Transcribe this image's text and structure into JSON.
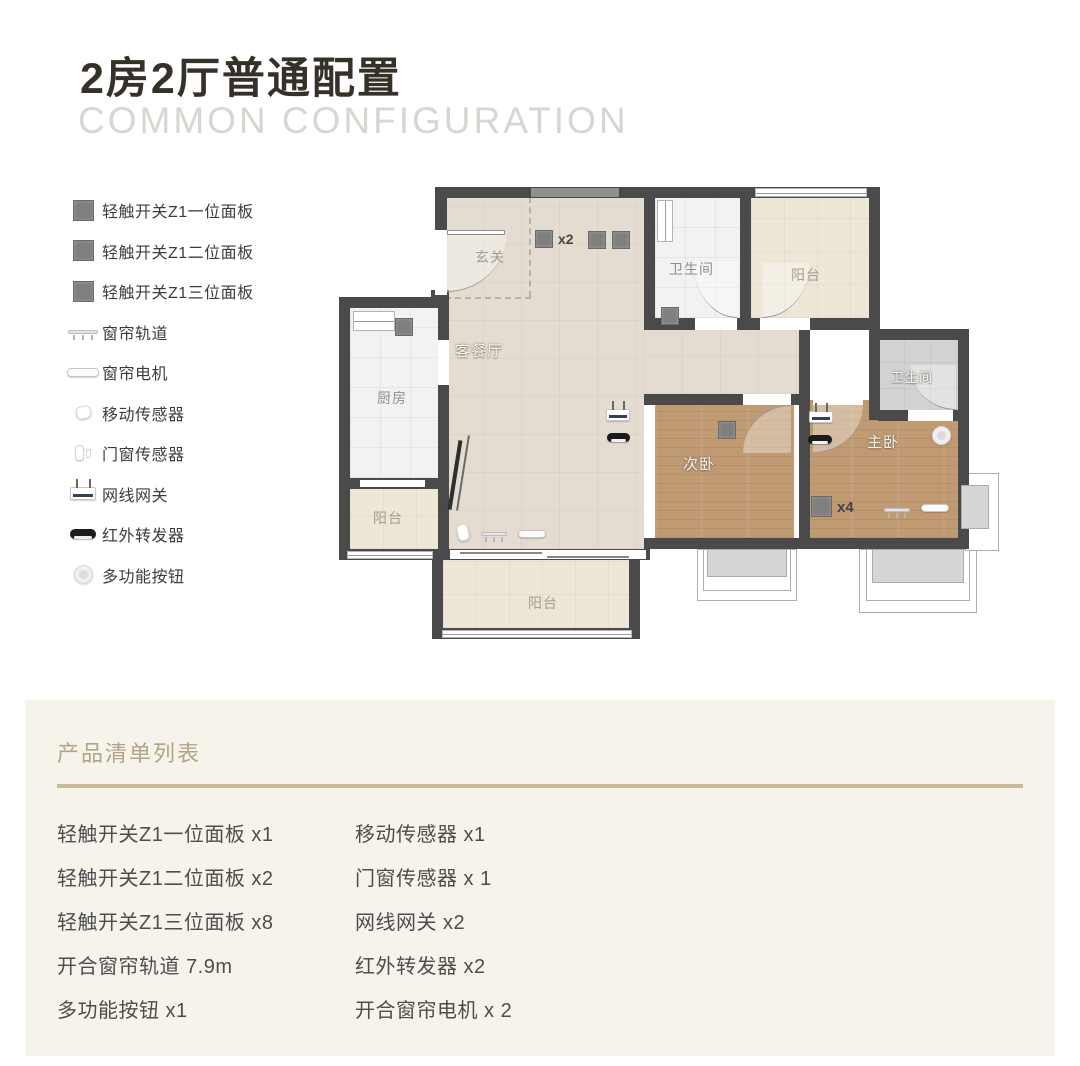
{
  "header": {
    "title": "2房2厅普通配置",
    "subtitle": "COMMON CONFIGURATION"
  },
  "legend": {
    "items": [
      {
        "icon": "switch-panel-icon",
        "label": "轻触开关Z1一位面板"
      },
      {
        "icon": "switch-panel-icon",
        "label": "轻触开关Z1二位面板"
      },
      {
        "icon": "switch-panel-icon",
        "label": "轻触开关Z1三位面板"
      },
      {
        "icon": "curtain-track-icon",
        "label": "窗帘轨道"
      },
      {
        "icon": "curtain-motor-icon",
        "label": "窗帘电机"
      },
      {
        "icon": "motion-sensor-icon",
        "label": "移动传感器"
      },
      {
        "icon": "door-sensor-icon",
        "label": "门窗传感器"
      },
      {
        "icon": "gateway-icon",
        "label": "网线网关"
      },
      {
        "icon": "ir-repeater-icon",
        "label": "红外转发器"
      },
      {
        "icon": "multi-button-icon",
        "label": "多功能按钮"
      }
    ]
  },
  "floorplan": {
    "rooms": {
      "entry": "玄关",
      "living": "客餐厅",
      "kitchen": "厨房",
      "bath1": "卫生间",
      "balcony_tr": "阳台",
      "bath2": "卫生间",
      "bedroom2": "次卧",
      "master": "主卧",
      "balcony_left": "阳台",
      "balcony_bottom": "阳台"
    },
    "multipliers": {
      "living_panels": "x2",
      "master_panels": "x4"
    }
  },
  "product_list": {
    "heading": "产品清单列表",
    "col1": [
      "轻触开关Z1一位面板 x1",
      "轻触开关Z1二位面板 x2",
      "轻触开关Z1三位面板 x8",
      "开合窗帘轨道 7.9m",
      "多功能按钮 x1"
    ],
    "col2": [
      "移动传感器 x1",
      "门窗传感器 x 1",
      "网线网关 x2",
      "红外转发器 x2",
      "开合窗帘电机 x 2"
    ]
  },
  "colors": {
    "accent_tan": "#b2a486",
    "panel_bg": "#f6f3eb",
    "wall": "#4a4a4a",
    "wood_floor": "#bf9a72",
    "tile_beige": "#e4dcd0",
    "switch_gray": "#7f7f7f"
  }
}
